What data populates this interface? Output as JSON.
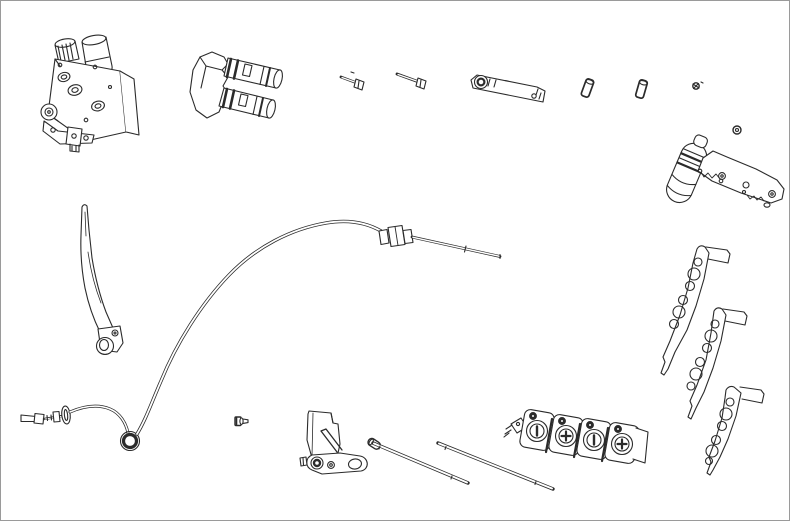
{
  "meta": {
    "title": "Exploded parts illustration",
    "kind": "technical line-art parts diagram",
    "visible_text": "none"
  },
  "canvas": {
    "width": 790,
    "height": 521,
    "background": "#ffffff",
    "border_color": "#9a9a9a",
    "line_color": "#2b2b2b"
  },
  "parts": [
    {
      "id": "control-valve-assembly",
      "label": "Control valve assembly",
      "bbox": [
        40,
        34,
        100,
        118
      ],
      "features": "tilted valve body, top solenoid cylinder, knurled cap, 3 port rings, pivot boss and clevis bracket"
    },
    {
      "id": "dual-solenoid-valve",
      "label": "Dual solenoid valve",
      "bbox": [
        188,
        50,
        96,
        70
      ],
      "features": "mount body with two ribbed coil cylinders angled down-right"
    },
    {
      "id": "bolt-short",
      "label": "Hex bolt (short)",
      "bbox": [
        338,
        70,
        28,
        22
      ]
    },
    {
      "id": "bolt-long",
      "label": "Hex bolt (long)",
      "bbox": [
        394,
        70,
        34,
        21
      ]
    },
    {
      "id": "mounting-plate",
      "label": "Mounting strap plate",
      "bbox": [
        470,
        66,
        77,
        40
      ],
      "features": "slim angled plate, ringed boss left end, small hole right end"
    },
    {
      "id": "roll-pin-1",
      "label": "Roll pin",
      "bbox": [
        580,
        76,
        15,
        23
      ]
    },
    {
      "id": "roll-pin-2",
      "label": "Roll pin",
      "bbox": [
        634,
        77,
        15,
        24
      ]
    },
    {
      "id": "set-screw",
      "label": "Set screw",
      "bbox": [
        689,
        79,
        15,
        13
      ]
    },
    {
      "id": "lock-nut",
      "label": "Lock nut",
      "bbox": [
        731,
        124,
        12,
        12
      ]
    },
    {
      "id": "handle-grip-assembly",
      "label": "Handle grip with bracket arm and spring",
      "bbox": [
        664,
        128,
        122,
        92
      ]
    },
    {
      "id": "lever-plate-1",
      "label": "Drilled lever plate 1",
      "bbox": [
        658,
        240,
        74,
        136
      ],
      "hole_count": 6
    },
    {
      "id": "lever-plate-2",
      "label": "Drilled lever plate 2",
      "bbox": [
        684,
        304,
        65,
        118
      ],
      "hole_count": 6
    },
    {
      "id": "lever-plate-3",
      "label": "Drilled lever plate 3",
      "bbox": [
        704,
        383,
        62,
        94
      ],
      "hole_count": 6
    },
    {
      "id": "hand-lever",
      "label": "Curved hand lever",
      "bbox": [
        74,
        202,
        50,
        158
      ]
    },
    {
      "id": "control-cable",
      "label": "Push-pull control cable",
      "bbox": [
        18,
        218,
        486,
        240
      ],
      "features": "clevis fork end, grommet, eyelet loop, long S-curve, mid adjuster fitting, tapered rod end"
    },
    {
      "id": "grub-screw",
      "label": "Grub screw",
      "bbox": [
        233,
        415,
        16,
        13
      ]
    },
    {
      "id": "pivot-bracket",
      "label": "Pivot bracket with arm",
      "bbox": [
        300,
        405,
        70,
        72
      ],
      "features": "vertical plate, diagonal strut, slotted arm with eye and boss"
    },
    {
      "id": "clevis-pin",
      "label": "Clevis pin",
      "bbox": [
        366,
        437,
        17,
        14
      ]
    },
    {
      "id": "link-rod-1",
      "label": "Threaded link rod 1",
      "bbox": [
        370,
        440,
        100,
        46
      ]
    },
    {
      "id": "link-rod-2",
      "label": "Threaded link rod 2",
      "bbox": [
        435,
        440,
        120,
        51
      ]
    },
    {
      "id": "valve-bank",
      "label": "4-section valve bank",
      "bbox": [
        504,
        408,
        145,
        58
      ],
      "knob_symbols": [
        "slot",
        "cross",
        "slot",
        "cross"
      ],
      "features": "four blocks each with round dial and corner bolt, elbow fitting at left"
    }
  ]
}
